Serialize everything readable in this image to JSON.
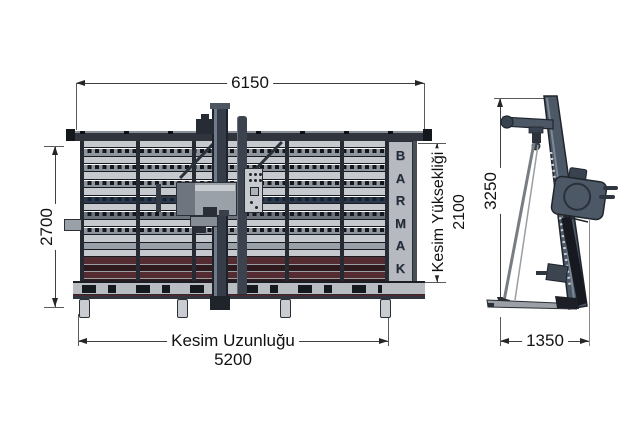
{
  "diagram": {
    "brand_letters": [
      "B",
      "A",
      "R",
      "M",
      "A",
      "K"
    ],
    "front_view": {
      "total_width": "6150",
      "total_height": "2700",
      "cut_length_label": "Kesim Uzunluğu",
      "cut_length_value": "5200",
      "cut_height_label": "Kesim Yüksekliği",
      "cut_height_value": "2100"
    },
    "side_view": {
      "total_height": "3250",
      "depth": "1350"
    }
  },
  "colors": {
    "steel_dark": "#272c34",
    "steel_mid": "#4d5866",
    "panel_gray": "#b6bac0",
    "slat_light": "#c6cace",
    "slat_dash": "#8f959d",
    "navy_row": "#2c3a50",
    "maroon_light": "#532b30",
    "maroon_dark": "#2e191d",
    "dim_line": "#3f3f3f",
    "text": "#121212"
  }
}
